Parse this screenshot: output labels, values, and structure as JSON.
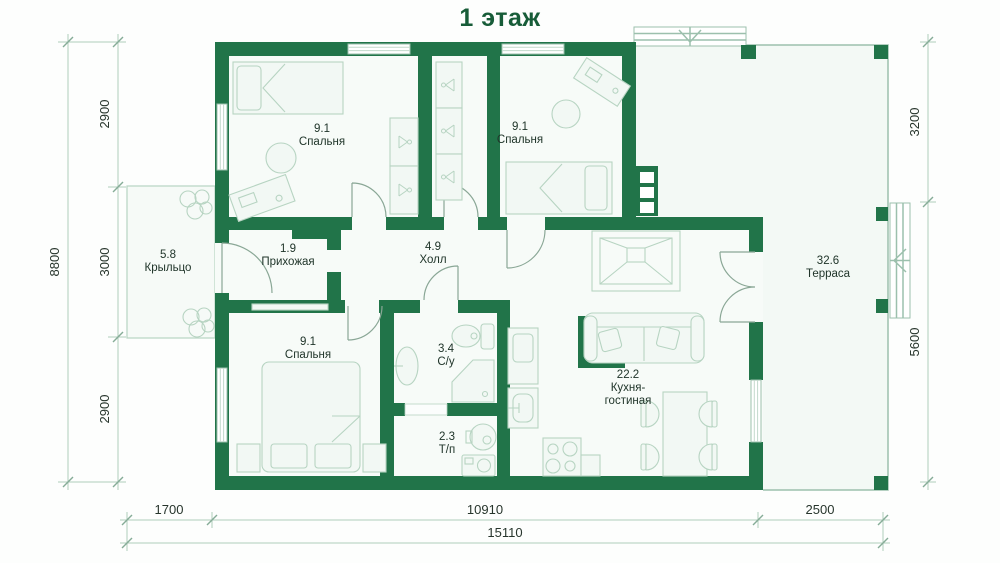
{
  "title": "1 этаж",
  "rooms": {
    "bedroom1": {
      "area": "9.1",
      "name": "Спальня"
    },
    "bedroom2": {
      "area": "9.1",
      "name": "Спальня"
    },
    "bedroom3": {
      "area": "9.1",
      "name": "Спальня"
    },
    "porch": {
      "area": "5.8",
      "name": "Крыльцо"
    },
    "entry": {
      "area": "1.9",
      "name": "Прихожая"
    },
    "hall": {
      "area": "4.9",
      "name": "Холл"
    },
    "bathroom": {
      "area": "3.4",
      "name": "С/у"
    },
    "utility": {
      "area": "2.3",
      "name": "Т/п"
    },
    "kitchen": {
      "area": "22.2",
      "name_line1": "Кухня-",
      "name_line2": "гостиная"
    },
    "terrace": {
      "area": "32.6",
      "name": "Терраса"
    }
  },
  "dimensions": {
    "left_total": "8800",
    "left_segments": [
      "2900",
      "3000",
      "2900"
    ],
    "right_segments": [
      "3200",
      "5600"
    ],
    "bottom_segments": [
      "1700",
      "10910",
      "2500"
    ],
    "bottom_total": "15110"
  },
  "colors": {
    "wall": "#217449",
    "title": "#175c38",
    "dim_line": "#aecdbb",
    "furniture": "#b7d4c2"
  }
}
